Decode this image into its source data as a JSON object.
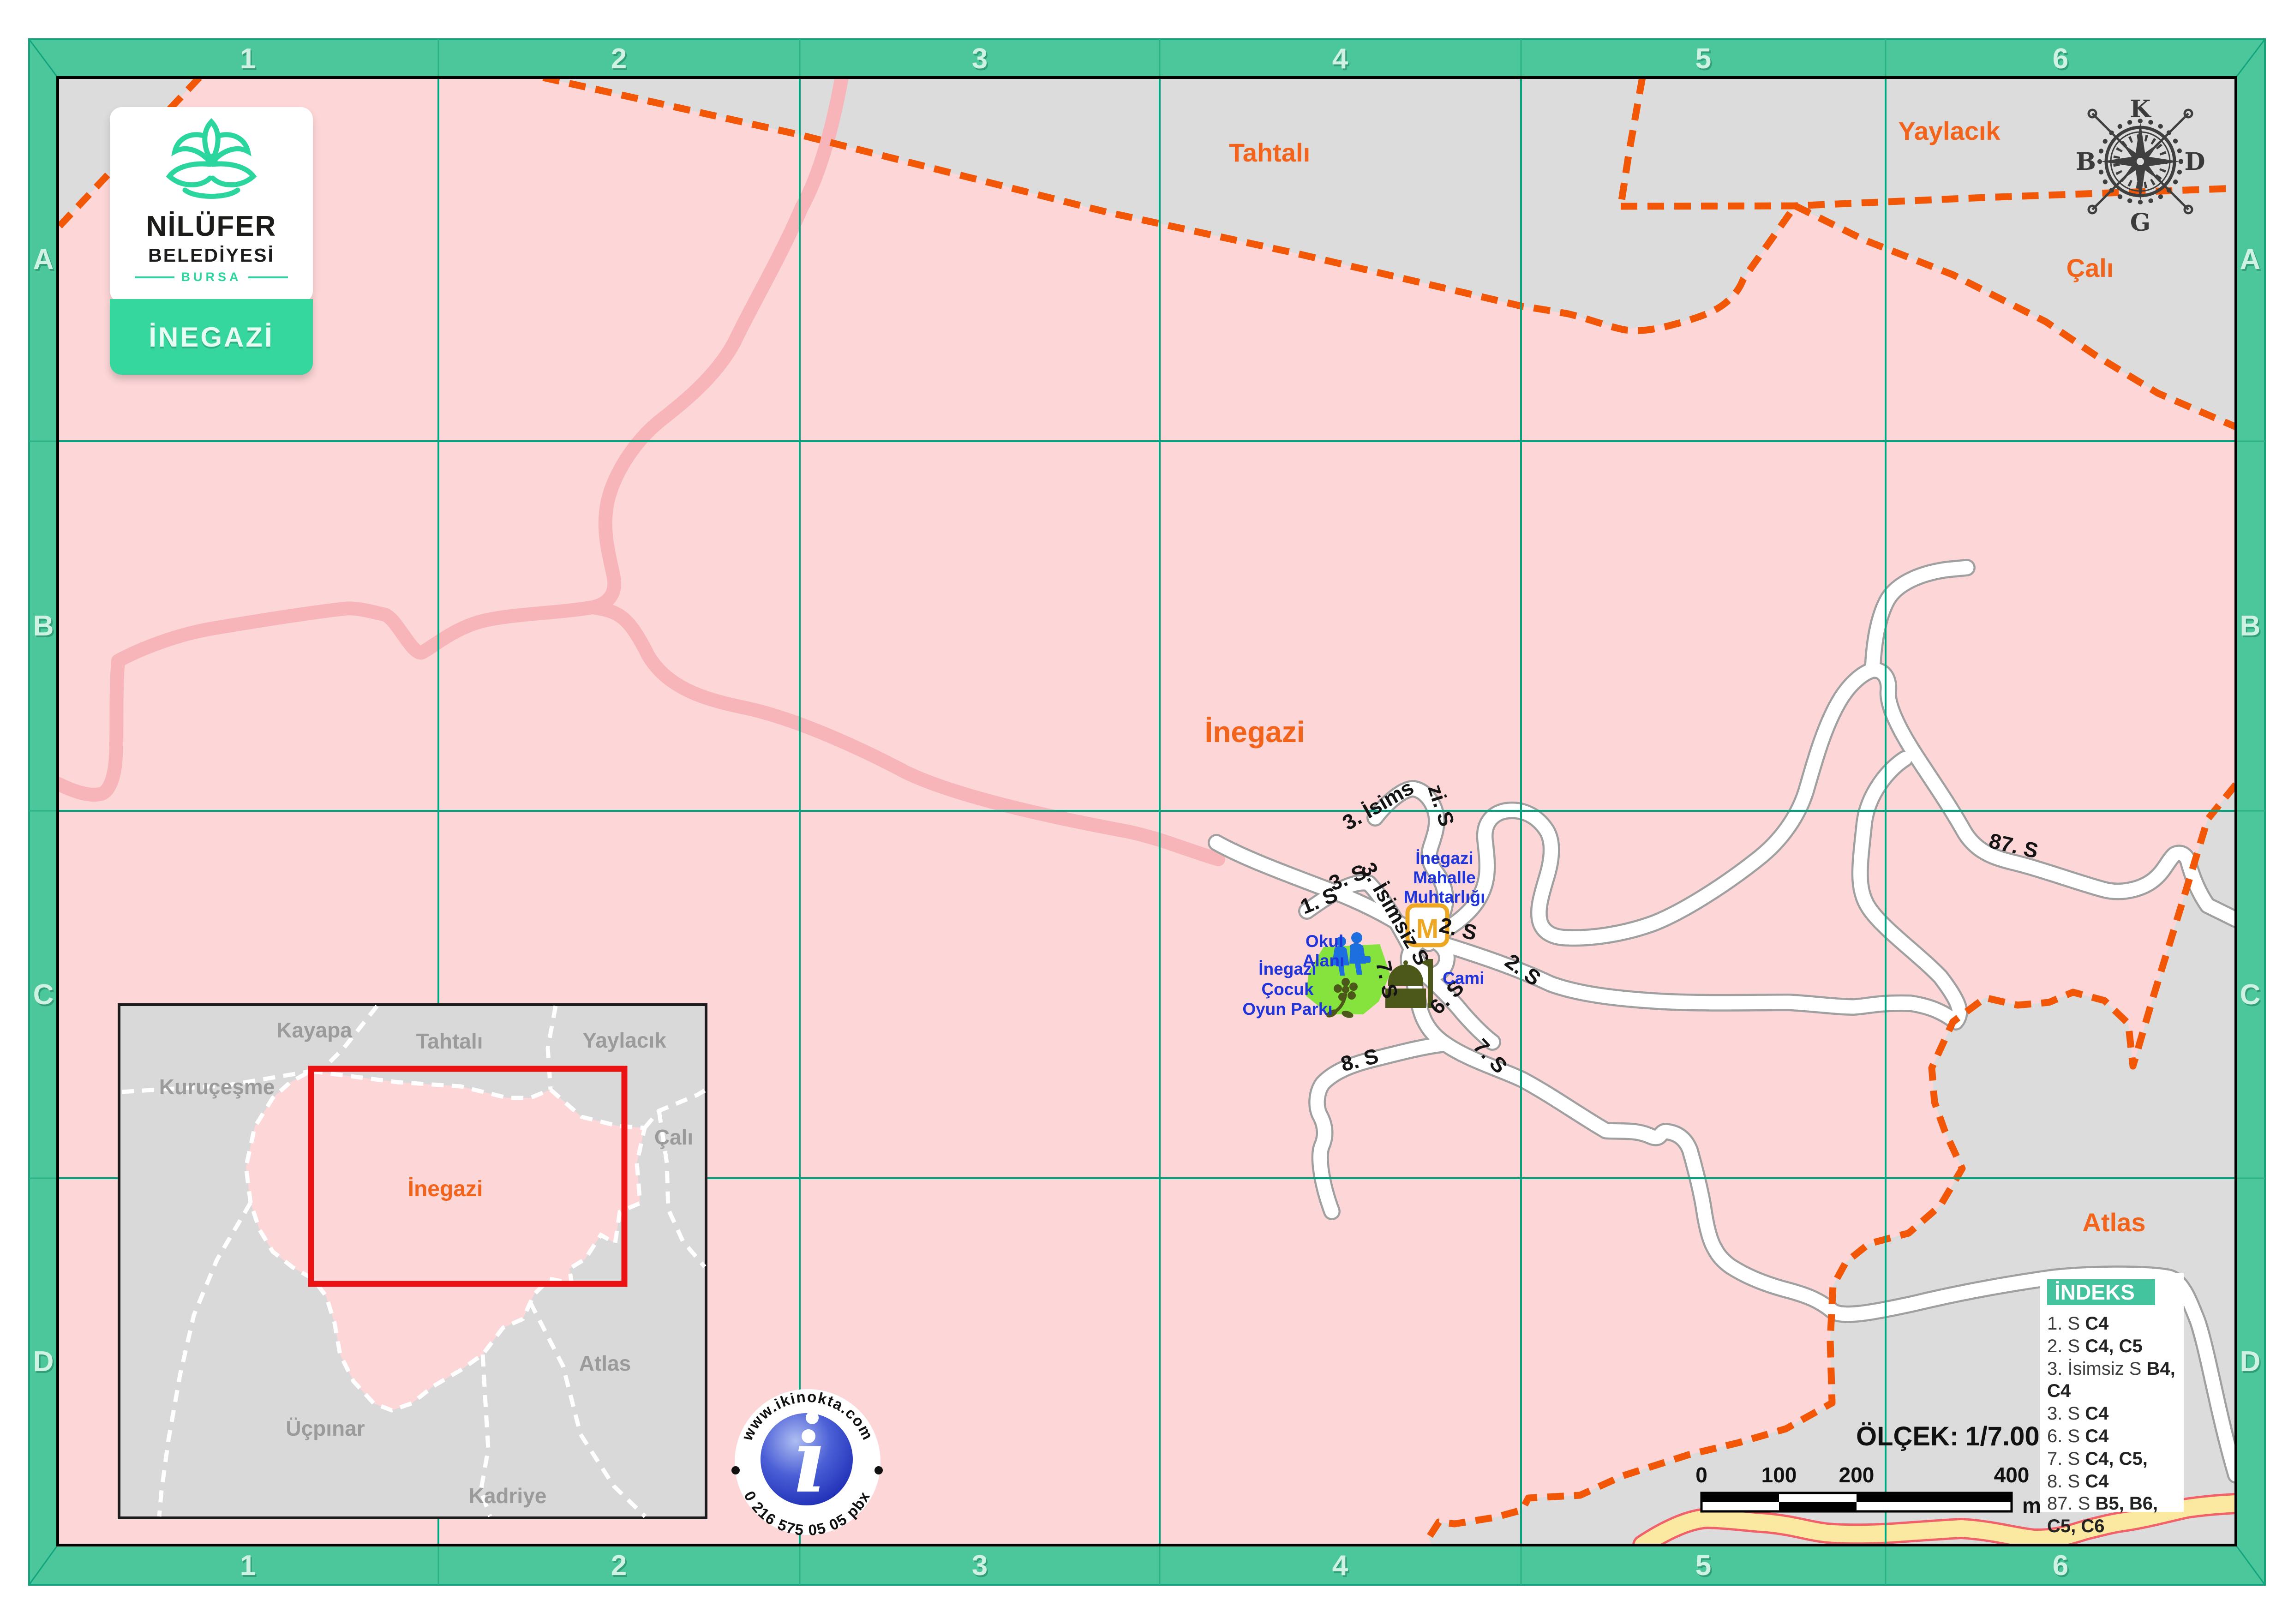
{
  "logo": {
    "line1": "NİLÜFER",
    "line2": "BELEDİYESİ",
    "line3": "BURSA",
    "banner": "İNEGAZİ"
  },
  "grid": {
    "cols": [
      "1",
      "2",
      "3",
      "4",
      "5",
      "6"
    ],
    "rows": [
      "A",
      "B",
      "C",
      "D"
    ]
  },
  "compass": {
    "n": "K",
    "e": "D",
    "s": "G",
    "w": "B"
  },
  "regions": {
    "tahtali": "Tahtalı",
    "yaylacik": "Yaylacık",
    "cali": "Çalı",
    "inegazi": "İnegazi",
    "atlas": "Atlas"
  },
  "streets": [
    {
      "text": "3. İsims"
    },
    {
      "text": "zi. S"
    },
    {
      "text": "3. S"
    },
    {
      "text": "3. İsimsiz S"
    },
    {
      "text": "1. S"
    },
    {
      "text": "2. S"
    },
    {
      "text": "2. S"
    },
    {
      "text": "6. S"
    },
    {
      "text": "7. S"
    },
    {
      "text": "7. S"
    },
    {
      "text": "8. S"
    },
    {
      "text": "87. S"
    }
  ],
  "pois": {
    "muhtarlik": {
      "l1": "İnegazi",
      "l2": "Mahalle",
      "l3": "Muhtarlığı"
    },
    "okul": {
      "l1": "Okul",
      "l2": "Alanı"
    },
    "cami": "Cami",
    "park": {
      "l1": "İnegazi",
      "l2": "Çocuk",
      "l3": "Oyun Parkı"
    },
    "m_badge": "M"
  },
  "inset": {
    "kayapa": "Kayapa",
    "tahtali": "Tahtalı",
    "yaylacik": "Yaylacık",
    "kurucesme": "Kuruçeşme",
    "cali": "Çalı",
    "inegazi": "İnegazi",
    "atlas": "Atlas",
    "ucpinar": "Üçpınar",
    "kadriye": "Kadriye"
  },
  "indeks": {
    "title": "İNDEKS",
    "items": [
      {
        "name": "1. S",
        "refs": "C4"
      },
      {
        "name": "2. S",
        "refs": "C4, C5"
      },
      {
        "name": "3. İsimsiz S",
        "refs": "B4, C4"
      },
      {
        "name": "3. S",
        "refs": "C4"
      },
      {
        "name": "6. S",
        "refs": "C4"
      },
      {
        "name": "7. S",
        "refs": "C4, C5,"
      },
      {
        "name": "8. S",
        "refs": "C4"
      },
      {
        "name": "87. S",
        "refs": "B5, B6, C5, C6"
      }
    ]
  },
  "scalebar": {
    "label": "ÖLÇEK:",
    "value": "1/7.000",
    "ticks": [
      "0",
      "100",
      "200",
      "400"
    ],
    "unit": "m"
  },
  "branding": {
    "url": "www.ikinokta.com",
    "phone": "0 216 575 05 05 pbx",
    "i": "ı"
  },
  "colors": {
    "frame": "#4cc79c",
    "frame_line": "#12a47c",
    "grid_line": "#00a47e",
    "pink": "#fdd7d8",
    "gray": "#dcdcdc",
    "boundary_orange": "#f25708",
    "region_label": "#f2641c",
    "poi_blue": "#1f35db",
    "park_green": "#86e33e",
    "olive_icon": "#4c581a",
    "badge_orange": "#eda722",
    "road_casing": "#a0a0a0",
    "yellow_road": "#fbe9a1",
    "yellow_casing": "#f2606a",
    "indeks_teal": "#43c39e",
    "red_rect": "#ea1212"
  }
}
